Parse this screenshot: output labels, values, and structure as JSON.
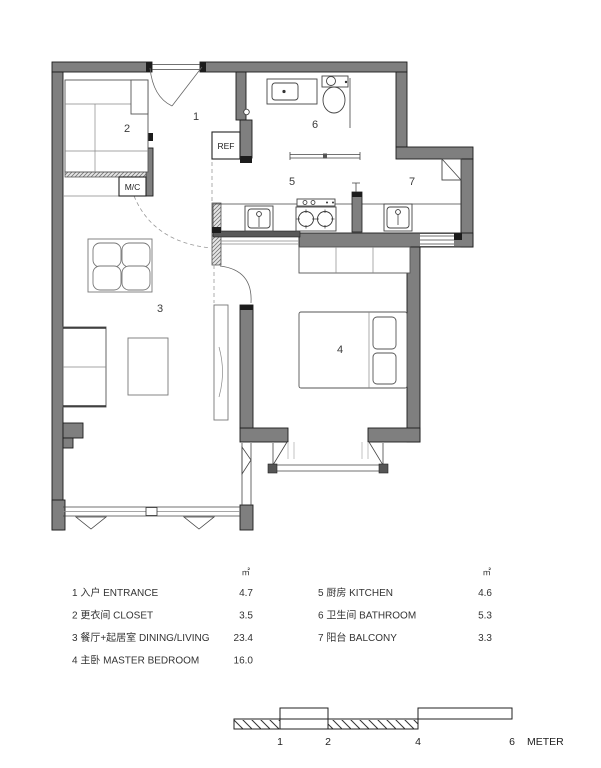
{
  "plan": {
    "rooms": {
      "entrance": "1",
      "closet": "2",
      "dining_living": "3",
      "master_bedroom": "4",
      "kitchen": "5",
      "bathroom": "6",
      "balcony": "7"
    },
    "appliances": {
      "refrigerator": "REF",
      "washing_machine": "M/C"
    }
  },
  "legend": {
    "unit": "㎡",
    "left": [
      {
        "label": "1 入户 ENTRANCE",
        "area": "4.7"
      },
      {
        "label": "2 更衣间 CLOSET",
        "area": "3.5"
      },
      {
        "label": "3 餐厅+起居室 DINING/LIVING",
        "area": "23.4"
      },
      {
        "label": "4 主卧 MASTER BEDROOM",
        "area": "16.0"
      }
    ],
    "right": [
      {
        "label": "5 厨房 KITCHEN",
        "area": "4.6"
      },
      {
        "label": "6 卫生间 BATHROOM",
        "area": "5.3"
      },
      {
        "label": "7 阳台 BALCONY",
        "area": "3.3"
      }
    ]
  },
  "scale_bar": {
    "ticks": [
      "1",
      "2",
      "4",
      "6"
    ],
    "unit_label": "METER"
  }
}
